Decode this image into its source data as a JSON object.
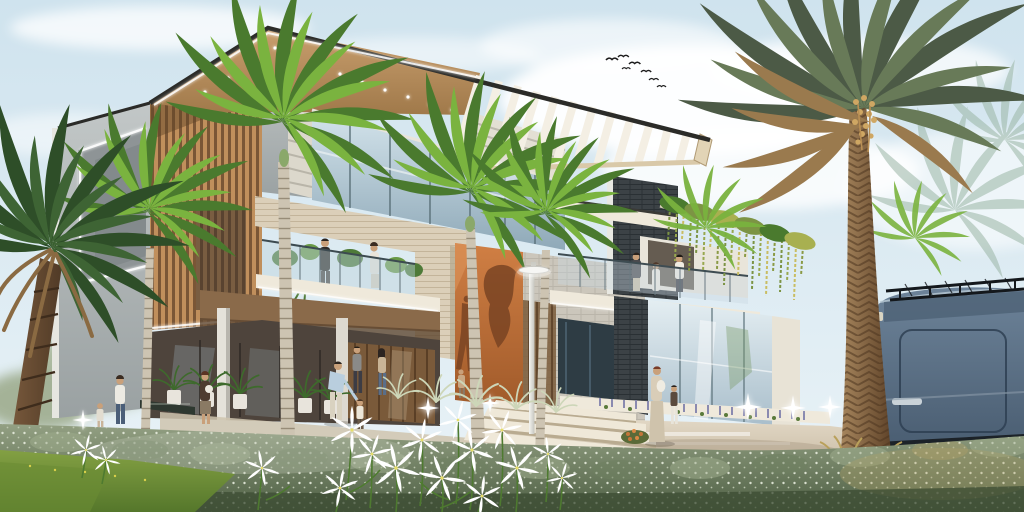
{
  "scene": {
    "title": "Modern tropical villa — exterior architectural rendering",
    "description": "3D rendering of a modern two-storey villa with a cantilevered slatted roof, timber louver screens, an LED-edged concrete tower, stone-clad glass balconies with residents, a terracotta feature wall with cast shadows, a right pavilion draped with hanging vines, royal palms, a large date palm, families strolling behind a silvery hedge dotted with white spider lilies, glowing ground lights on a paved walkway, and a slate-blue van with a roof rack parked at right under a pale afternoon sky with a small flock of birds.",
    "time_of_day": "late afternoon",
    "people_count": 17,
    "bird_count": 7,
    "palm_tree_count": 9,
    "ground_light_count": 6,
    "elements": [
      "sky with soft clouds",
      "flock of birds",
      "cantilever roof with pergola slats",
      "timber louver screen",
      "LED-edged concrete tower",
      "stone-clad balcony with glass railing",
      "terracotta feature wall with shadows",
      "pavilion with hanging vines and balcony",
      "street lamp",
      "royal palms",
      "date palm",
      "slate-blue van with roof rack",
      "paved walkway with ground lights",
      "silver hedge",
      "white spider lilies",
      "lawn"
    ]
  },
  "palette": {
    "sky-top": "#cfe3ee",
    "sky-bottom": "#eaf3f7",
    "cloud": "#ffffff",
    "roof-edge": "#2b2b28",
    "ceiling-wood-1": "#c99f6e",
    "ceiling-wood-2": "#a0794a",
    "pergola-slat": "#f4efe4",
    "pergola-rail": "#d9c9a9",
    "fascia-cream": "#e2d4b6",
    "concrete-1": "#c2c7c7",
    "concrete-2": "#9aa1a2",
    "recess-gray": "#8e9496",
    "louver-light": "#c08f5c",
    "louver-dark": "#7a5636",
    "glass-top": "#d4e4ec",
    "glass-bottom": "#8fa9b8",
    "glass2-top": "#e4eef2",
    "glass2-bottom": "#a9becb",
    "mullion": "#5a7078",
    "stone": "#dbcfb9",
    "stone-line": "#c3b49a",
    "brick": "#cbc6bb",
    "brick-line": "#b5b0a4",
    "slate": "#3c4246",
    "slate-line": "#2a3034",
    "white-trim": "#efe9db",
    "soffit-wood": "#8a6a4a",
    "interior-dark": "#4e443c",
    "door-wood": "#7a5a3a",
    "orange-1": "#d07f44",
    "orange-2": "#a05a2a",
    "orange-shadow": "#7a4423",
    "vine-green": "#7c9444",
    "vine-yellow": "#c9bd62",
    "palm-dark": "#4a7a2e",
    "palm-light": "#7ab33f",
    "date-frond-dark": "#4c5a46",
    "date-frond-mid": "#687a58",
    "date-frond-dry": "#9a7a4e",
    "date-trunk-1": "#a8875e",
    "date-trunk-2": "#5e4228",
    "royal-trunk": "#cdc4b2",
    "royal-trunk-ring": "#978c78",
    "left-palm-green": "#2e4e28",
    "left-palm-trunk-1": "#7c5c3e",
    "left-palm-trunk-2": "#503a26",
    "hedge-1": "#93a083",
    "hedge-2": "#4e5f44",
    "hedge-speckle": "#e6ebdc",
    "hedge-shadow": "#3c4c33",
    "grass-1": "#83a043",
    "grass-2": "#55772b",
    "pave-1": "#e2d8c6",
    "pave-2": "#c6b8a0",
    "step-stone": "#efe8d8",
    "lily-white": "#ffffff",
    "lily-stem": "#4e7a30",
    "lavender-flower": "#8a8ab0",
    "van-1": "#6d8399",
    "van-2": "#45586c",
    "van-trim-dark": "#1c2228",
    "rack-black": "#14181c",
    "lamp-white": "#f0f0ec",
    "led-white": "#ffffff",
    "skin": "#c9a07a",
    "water-dark": "#2e3830"
  }
}
